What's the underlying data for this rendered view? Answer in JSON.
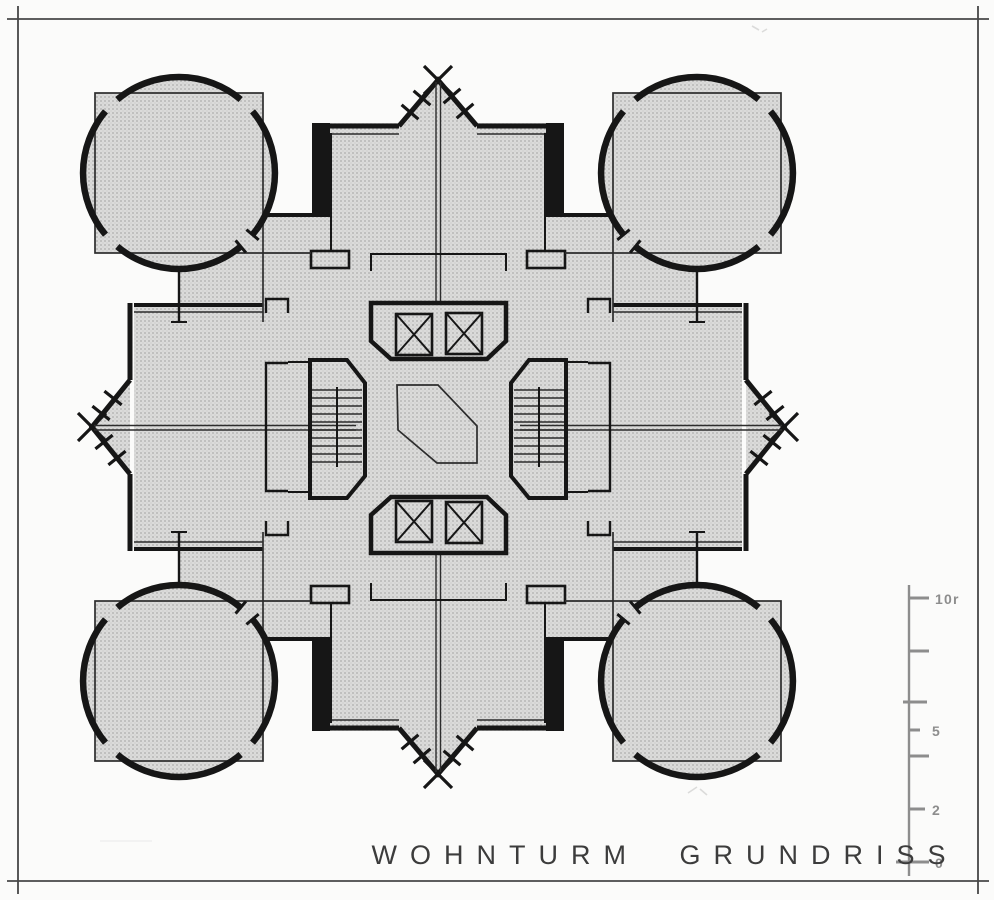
{
  "title": "WOHNTURM GRUNDRISS",
  "scale_bar": {
    "labels": [
      "10r",
      "5",
      "2",
      "0"
    ],
    "tick_count": 7
  },
  "colors": {
    "paper": "#fbfbfa",
    "plan-gray": "#d9d9d9",
    "dot": "#a6a6a6",
    "wall": "#161616",
    "line": "#2d2d2d",
    "frame": "#474747",
    "scale": "#8d8d8d",
    "title": "#3c3c3c"
  }
}
